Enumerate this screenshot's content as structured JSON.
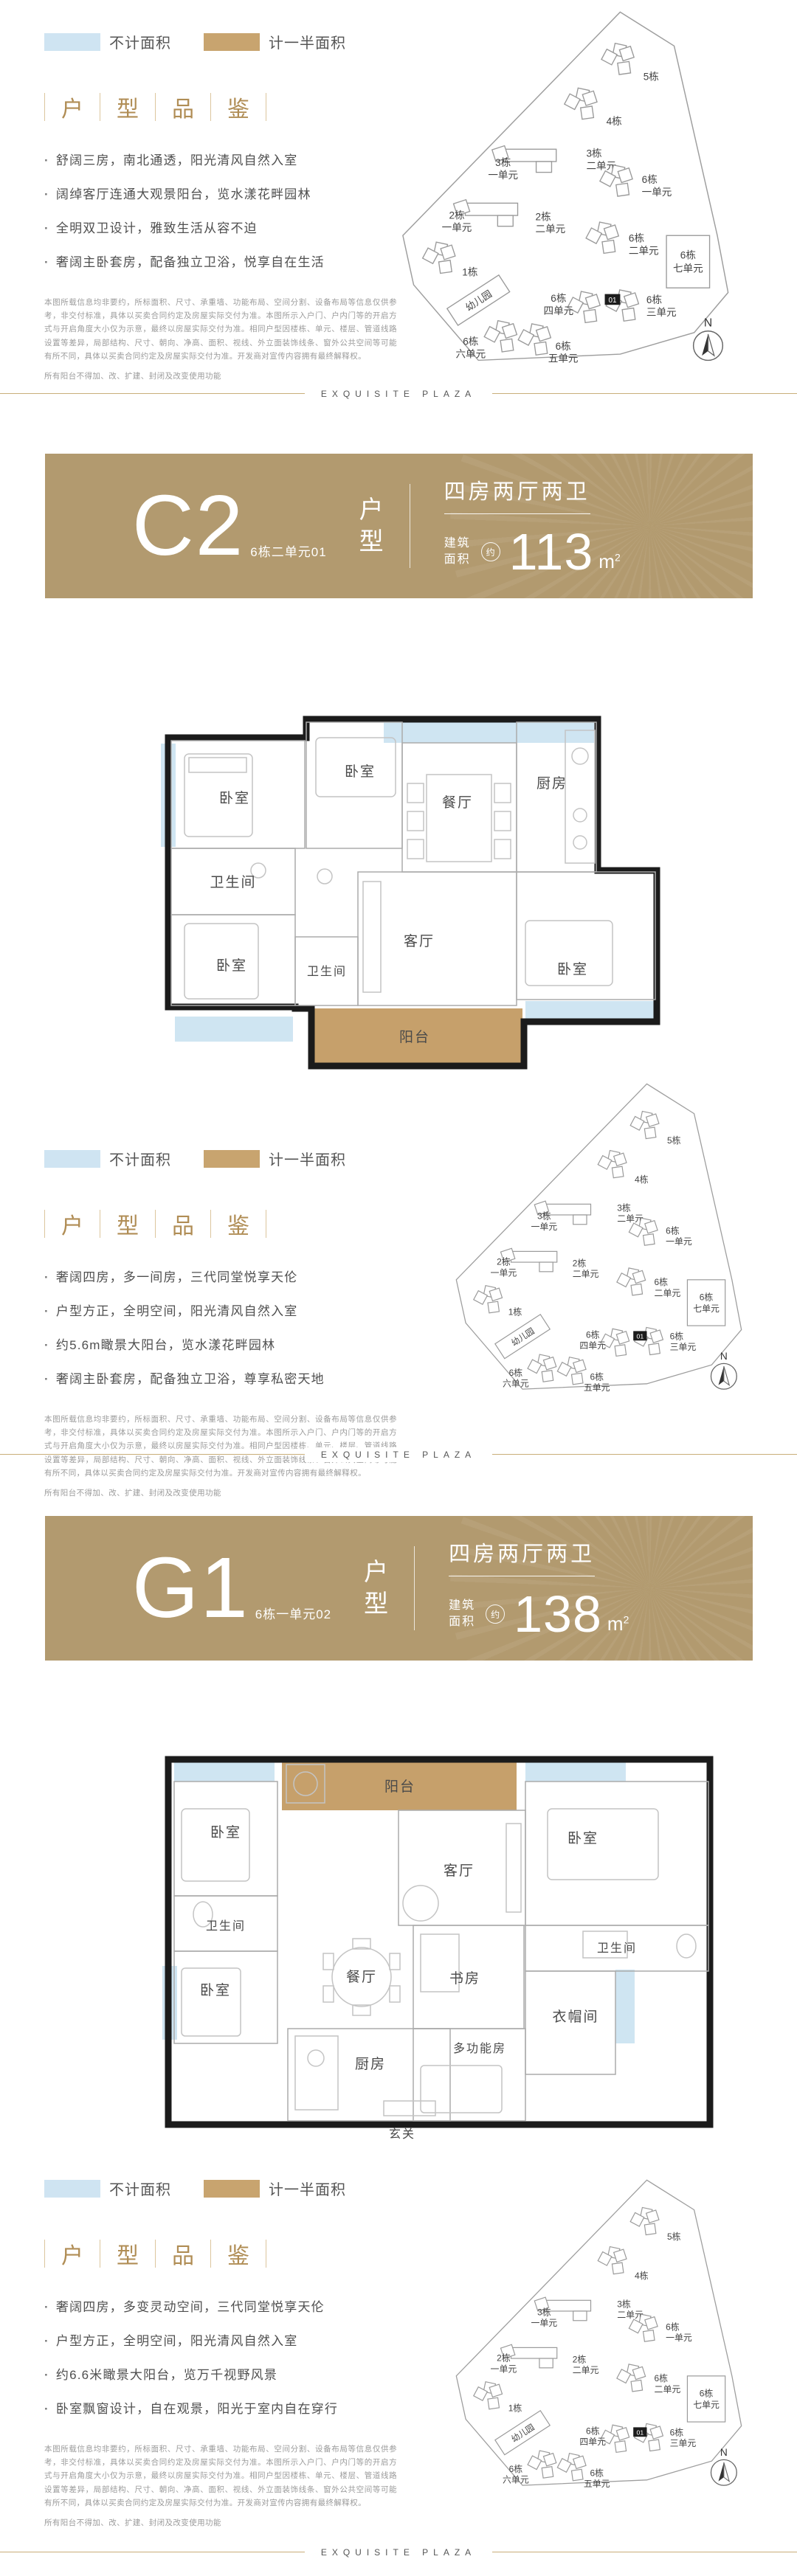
{
  "brand_footer": "EXQUISITE PLAZA",
  "legend": {
    "items": [
      {
        "label": "不计面积",
        "color": "#cfe4f2"
      },
      {
        "label": "计一半面积",
        "color": "#c8a46f"
      }
    ]
  },
  "review": {
    "chars": [
      "户",
      "型",
      "品",
      "鉴"
    ]
  },
  "sections": [
    {
      "bullets": [
        "舒阔三房，南北通透，阳光清风自然入室",
        "阔绰客厅连通大观景阳台，览水漾花畔园林",
        "全明双卫设计，雅致生活从容不迫",
        "奢阔主卧套房，配备独立卫浴，悦享自在生活"
      ]
    },
    {
      "bullets": [
        "奢阔四房，多一间房，三代同堂悦享天伦",
        "户型方正，全明空间，阳光清风自然入室",
        "约5.6m瞰景大阳台，览水漾花畔园林",
        "奢阔主卧套房，配备独立卫浴，尊享私密天地"
      ]
    },
    {
      "bullets": [
        "奢阔四房，多变灵动空间，三代同堂悦享天伦",
        "户型方正，全明空间，阳光清风自然入室",
        "约6.6米瞰景大阳台，览万千视野风景",
        "卧室飘窗设计，自在观景，阳光于室内自在穿行"
      ]
    }
  ],
  "disclaimer": {
    "body": "本图所载信息均非要约，所标面积、尺寸、承重墙、功能布局、空间分割、设备布局等信息仅供参考，非交付标准，具体以买卖合同约定及房屋实际交付为准。本图所示入户门、户内门等的开启方式与开启角度大小仅为示意，最终以房屋实际交付为准。相同户型因楼栋、单元、楼层、管道线路设置等差异，局部结构、尺寸、朝向、净高、面积、视线、外立面装饰线条、窗外公共空间等可能有所不同，具体以买卖合同约定及房屋实际交付为准。开发商对宣传内容拥有最终解释权。",
    "balcony_note": "所有阳台不得加、改、扩建、封闭及改变使用功能"
  },
  "units": [
    {
      "code": "C2",
      "unit_no": "6栋二单元01",
      "type_label": "户型",
      "layout": "四房两厅两卫",
      "area_label": "建筑面积",
      "approx": "约",
      "area_value": "113",
      "area_unit_base": "m",
      "area_unit_exp": "2"
    },
    {
      "code": "G1",
      "unit_no": "6栋一单元02",
      "type_label": "户型",
      "layout": "四房两厅两卫",
      "area_label": "建筑面积",
      "approx": "约",
      "area_value": "138",
      "area_unit_base": "m",
      "area_unit_exp": "2"
    }
  ],
  "siteplan": {
    "compass": "N",
    "highlight_unit": "01",
    "kindergarten": "幼儿园",
    "buildings": [
      {
        "name": "5栋"
      },
      {
        "name": "4栋"
      },
      {
        "name": "3栋",
        "unit": "一单元"
      },
      {
        "name": "3栋",
        "unit": "二单元"
      },
      {
        "name": "6栋",
        "unit": "一单元"
      },
      {
        "name": "2栋",
        "unit": "一单元"
      },
      {
        "name": "2栋",
        "unit": "二单元"
      },
      {
        "name": "6栋",
        "unit": "二单元"
      },
      {
        "name": "6栋",
        "unit": "七单元"
      },
      {
        "name": "1栋"
      },
      {
        "name": "6栋",
        "unit": "四单元"
      },
      {
        "name": "6栋",
        "unit": "三单元"
      },
      {
        "name": "6栋",
        "unit": "六单元"
      },
      {
        "name": "6栋",
        "unit": "五单元"
      }
    ]
  },
  "floorplans": {
    "c2": {
      "rooms": [
        "卧室",
        "卧室",
        "餐厅",
        "厨房",
        "卫生间",
        "卧室",
        "卫生间",
        "客厅",
        "卧室",
        "阳台"
      ]
    },
    "g1": {
      "rooms": [
        "阳台",
        "卧室",
        "客厅",
        "卧室",
        "卫生间",
        "卧室",
        "餐厅",
        "厨房",
        "书房",
        "玄关",
        "多功能房",
        "卫生间",
        "衣帽间"
      ]
    }
  }
}
